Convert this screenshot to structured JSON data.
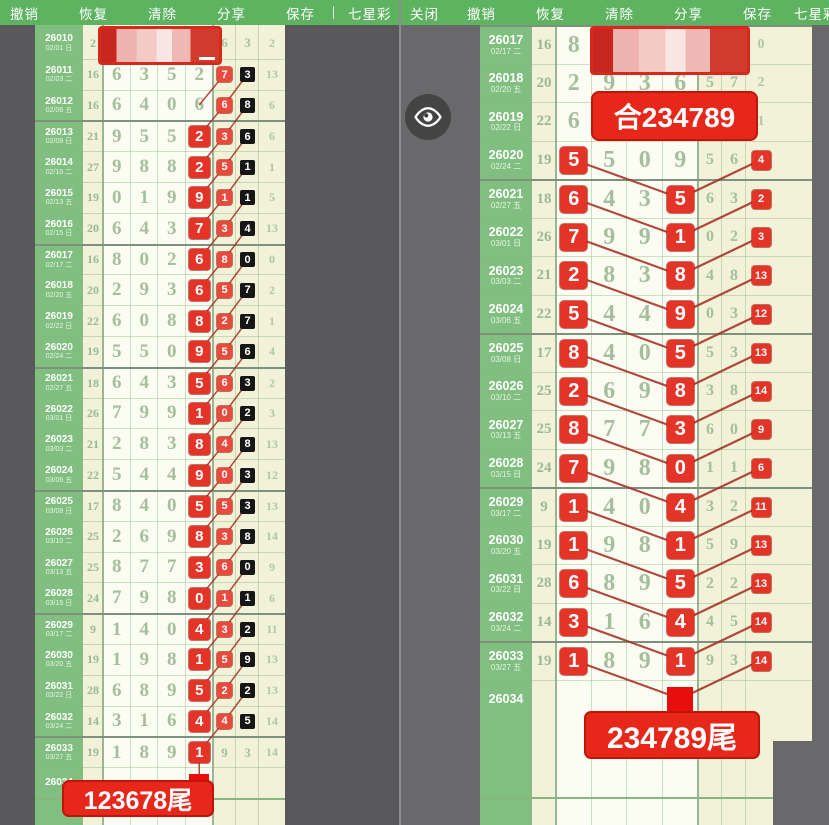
{
  "toolbar_left": {
    "items": [
      "撤销",
      "恢复",
      "清除",
      "分享",
      "保存"
    ],
    "lottery_label": "七星彩"
  },
  "toolbar_right": {
    "close_label": "关闭",
    "items": [
      "撤销",
      "恢复",
      "清除",
      "分享",
      "保存"
    ],
    "lottery_label": "七星彩"
  },
  "colors": {
    "accent_red": "#e43428",
    "toolbar_green": "#5db360",
    "panel_green": "#81bf81",
    "cream": "#f1f2d7",
    "black_mark": "#161616"
  },
  "left_panel": {
    "tail_label": "123678尾",
    "rows": [
      {
        "issue": "26010",
        "date": "02/01 日",
        "sum": "2",
        "d": [
          "",
          "",
          "",
          "",
          "6",
          "3"
        ],
        "m": [
          null,
          null,
          null,
          null,
          null,
          null
        ],
        "last": "2",
        "censored": true
      },
      {
        "issue": "26011",
        "date": "02/03 二",
        "sum": "16",
        "d": [
          "6",
          "3",
          "5",
          "2",
          "7",
          "3"
        ],
        "m": [
          null,
          null,
          null,
          null,
          "r",
          "b"
        ],
        "last": "13"
      },
      {
        "issue": "26012",
        "date": "02/06 五",
        "sum": "16",
        "d": [
          "6",
          "4",
          "0",
          "6",
          "6",
          "8"
        ],
        "m": [
          null,
          null,
          null,
          null,
          "r",
          "b"
        ],
        "last": "6"
      },
      {
        "issue": "26013",
        "date": "02/08 日",
        "sum": "21",
        "d": [
          "9",
          "5",
          "5",
          "2",
          "3",
          "6"
        ],
        "m": [
          null,
          null,
          null,
          "R",
          "r",
          "b"
        ],
        "last": "6"
      },
      {
        "issue": "26014",
        "date": "02/10 二",
        "sum": "27",
        "d": [
          "9",
          "8",
          "8",
          "2",
          "5",
          "1"
        ],
        "m": [
          null,
          null,
          null,
          "R",
          "r",
          "b"
        ],
        "last": "1"
      },
      {
        "issue": "26015",
        "date": "02/13 五",
        "sum": "19",
        "d": [
          "0",
          "1",
          "9",
          "9",
          "1",
          "1"
        ],
        "m": [
          null,
          null,
          null,
          "R",
          "r",
          "b"
        ],
        "last": "5"
      },
      {
        "issue": "26016",
        "date": "02/15 日",
        "sum": "20",
        "d": [
          "6",
          "4",
          "3",
          "7",
          "3",
          "4"
        ],
        "m": [
          null,
          null,
          null,
          "R",
          "r",
          "b"
        ],
        "last": "13"
      },
      {
        "issue": "26017",
        "date": "02/17 二",
        "sum": "16",
        "d": [
          "8",
          "0",
          "2",
          "6",
          "8",
          "0"
        ],
        "m": [
          null,
          null,
          null,
          "R",
          "r",
          "b"
        ],
        "last": "0"
      },
      {
        "issue": "26018",
        "date": "02/20 五",
        "sum": "20",
        "d": [
          "2",
          "9",
          "3",
          "6",
          "5",
          "7"
        ],
        "m": [
          null,
          null,
          null,
          "R",
          "r",
          "b"
        ],
        "last": "2"
      },
      {
        "issue": "26019",
        "date": "02/22 日",
        "sum": "22",
        "d": [
          "6",
          "0",
          "8",
          "8",
          "2",
          "7"
        ],
        "m": [
          null,
          null,
          null,
          "R",
          "r",
          "b"
        ],
        "last": "1"
      },
      {
        "issue": "26020",
        "date": "02/24 二",
        "sum": "19",
        "d": [
          "5",
          "5",
          "0",
          "9",
          "5",
          "6"
        ],
        "m": [
          null,
          null,
          null,
          "R",
          "r",
          "b"
        ],
        "last": "4"
      },
      {
        "issue": "26021",
        "date": "02/27 五",
        "sum": "18",
        "d": [
          "6",
          "4",
          "3",
          "5",
          "6",
          "3"
        ],
        "m": [
          null,
          null,
          null,
          "R",
          "r",
          "b"
        ],
        "last": "2"
      },
      {
        "issue": "26022",
        "date": "03/01 日",
        "sum": "26",
        "d": [
          "7",
          "9",
          "9",
          "1",
          "0",
          "2"
        ],
        "m": [
          null,
          null,
          null,
          "R",
          "r",
          "b"
        ],
        "last": "3"
      },
      {
        "issue": "26023",
        "date": "03/03 二",
        "sum": "21",
        "d": [
          "2",
          "8",
          "3",
          "8",
          "4",
          "8"
        ],
        "m": [
          null,
          null,
          null,
          "R",
          "r",
          "b"
        ],
        "last": "13"
      },
      {
        "issue": "26024",
        "date": "03/06 五",
        "sum": "22",
        "d": [
          "5",
          "4",
          "4",
          "9",
          "0",
          "3"
        ],
        "m": [
          null,
          null,
          null,
          "R",
          "r",
          "b"
        ],
        "last": "12"
      },
      {
        "issue": "26025",
        "date": "03/08 日",
        "sum": "17",
        "d": [
          "8",
          "4",
          "0",
          "5",
          "5",
          "3"
        ],
        "m": [
          null,
          null,
          null,
          "R",
          "r",
          "b"
        ],
        "last": "13"
      },
      {
        "issue": "26026",
        "date": "03/10 二",
        "sum": "25",
        "d": [
          "2",
          "6",
          "9",
          "8",
          "3",
          "8"
        ],
        "m": [
          null,
          null,
          null,
          "R",
          "r",
          "b"
        ],
        "last": "14"
      },
      {
        "issue": "26027",
        "date": "03/13 五",
        "sum": "25",
        "d": [
          "8",
          "7",
          "7",
          "3",
          "6",
          "0"
        ],
        "m": [
          null,
          null,
          null,
          "R",
          "r",
          "b"
        ],
        "last": "9"
      },
      {
        "issue": "26028",
        "date": "03/15 日",
        "sum": "24",
        "d": [
          "7",
          "9",
          "8",
          "0",
          "1",
          "1"
        ],
        "m": [
          null,
          null,
          null,
          "R",
          "r",
          "b"
        ],
        "last": "6"
      },
      {
        "issue": "26029",
        "date": "03/17 二",
        "sum": "9",
        "d": [
          "1",
          "4",
          "0",
          "4",
          "3",
          "2"
        ],
        "m": [
          null,
          null,
          null,
          "R",
          "r",
          "b"
        ],
        "last": "11"
      },
      {
        "issue": "26030",
        "date": "03/20 五",
        "sum": "19",
        "d": [
          "1",
          "9",
          "8",
          "1",
          "5",
          "9"
        ],
        "m": [
          null,
          null,
          null,
          "R",
          "r",
          "b"
        ],
        "last": "13"
      },
      {
        "issue": "26031",
        "date": "03/22 日",
        "sum": "28",
        "d": [
          "6",
          "8",
          "9",
          "5",
          "2",
          "2"
        ],
        "m": [
          null,
          null,
          null,
          "R",
          "r",
          "b"
        ],
        "last": "13"
      },
      {
        "issue": "26032",
        "date": "03/24 二",
        "sum": "14",
        "d": [
          "3",
          "1",
          "6",
          "4",
          "4",
          "5"
        ],
        "m": [
          null,
          null,
          null,
          "R",
          "r",
          "b"
        ],
        "last": "14"
      },
      {
        "issue": "26033",
        "date": "03/27 五",
        "sum": "19",
        "d": [
          "1",
          "8",
          "9",
          "1",
          "9",
          "3"
        ],
        "m": [
          null,
          null,
          null,
          "R",
          null,
          null
        ],
        "last": "14"
      },
      {
        "issue": "26034",
        "date": "",
        "sum": "",
        "d": [
          "",
          "",
          "",
          "",
          "",
          ""
        ],
        "m": [
          null,
          null,
          null,
          "SQ",
          null,
          null
        ],
        "last": ""
      }
    ]
  },
  "right_panel": {
    "tail_label": "234789尾",
    "sum_annotation": "合234789",
    "rows": [
      {
        "issue": "26017",
        "date": "02/17 二",
        "sum": "16",
        "d": [
          "8",
          "",
          "",
          "",
          "",
          ""
        ],
        "m": [
          null,
          null,
          null,
          null,
          null,
          null
        ],
        "last": "0",
        "censored": true
      },
      {
        "issue": "26018",
        "date": "02/20 五",
        "sum": "20",
        "d": [
          "2",
          "9",
          "3",
          "6",
          "5",
          "7"
        ],
        "m": [
          null,
          null,
          null,
          null,
          null,
          null
        ],
        "last": "2"
      },
      {
        "issue": "26019",
        "date": "02/22 日",
        "sum": "22",
        "d": [
          "6",
          "",
          "",
          "",
          "",
          ""
        ],
        "m": [
          null,
          null,
          null,
          null,
          null,
          null
        ],
        "last": "1"
      },
      {
        "issue": "26020",
        "date": "02/24 二",
        "sum": "19",
        "d": [
          "5",
          "5",
          "0",
          "9",
          "5",
          "6"
        ],
        "m": [
          "R",
          null,
          null,
          null,
          null,
          null
        ],
        "last": "4",
        "lastM": "R"
      },
      {
        "issue": "26021",
        "date": "02/27 五",
        "sum": "18",
        "d": [
          "6",
          "4",
          "3",
          "5",
          "6",
          "3"
        ],
        "m": [
          "R",
          null,
          null,
          "R",
          null,
          null
        ],
        "last": "2",
        "lastM": "R"
      },
      {
        "issue": "26022",
        "date": "03/01 日",
        "sum": "26",
        "d": [
          "7",
          "9",
          "9",
          "1",
          "0",
          "2"
        ],
        "m": [
          "R",
          null,
          null,
          "R",
          null,
          null
        ],
        "last": "3",
        "lastM": "R"
      },
      {
        "issue": "26023",
        "date": "03/03 二",
        "sum": "21",
        "d": [
          "2",
          "8",
          "3",
          "8",
          "4",
          "8"
        ],
        "m": [
          "R",
          null,
          null,
          "R",
          null,
          null
        ],
        "last": "13",
        "lastM": "R"
      },
      {
        "issue": "26024",
        "date": "03/06 五",
        "sum": "22",
        "d": [
          "5",
          "4",
          "4",
          "9",
          "0",
          "3"
        ],
        "m": [
          "R",
          null,
          null,
          "R",
          null,
          null
        ],
        "last": "12",
        "lastM": "R"
      },
      {
        "issue": "26025",
        "date": "03/08 日",
        "sum": "17",
        "d": [
          "8",
          "4",
          "0",
          "5",
          "5",
          "3"
        ],
        "m": [
          "R",
          null,
          null,
          "R",
          null,
          null
        ],
        "last": "13",
        "lastM": "R"
      },
      {
        "issue": "26026",
        "date": "03/10 二",
        "sum": "25",
        "d": [
          "2",
          "6",
          "9",
          "8",
          "3",
          "8"
        ],
        "m": [
          "R",
          null,
          null,
          "R",
          null,
          null
        ],
        "last": "14",
        "lastM": "R"
      },
      {
        "issue": "26027",
        "date": "03/13 五",
        "sum": "25",
        "d": [
          "8",
          "7",
          "7",
          "3",
          "6",
          "0"
        ],
        "m": [
          "R",
          null,
          null,
          "R",
          null,
          null
        ],
        "last": "9",
        "lastM": "R"
      },
      {
        "issue": "26028",
        "date": "03/15 日",
        "sum": "24",
        "d": [
          "7",
          "9",
          "8",
          "0",
          "1",
          "1"
        ],
        "m": [
          "R",
          null,
          null,
          "R",
          null,
          null
        ],
        "last": "6",
        "lastM": "R"
      },
      {
        "issue": "26029",
        "date": "03/17 二",
        "sum": "9",
        "d": [
          "1",
          "4",
          "0",
          "4",
          "3",
          "2"
        ],
        "m": [
          "R",
          null,
          null,
          "R",
          null,
          null
        ],
        "last": "11",
        "lastM": "R"
      },
      {
        "issue": "26030",
        "date": "03/20 五",
        "sum": "19",
        "d": [
          "1",
          "9",
          "8",
          "1",
          "5",
          "9"
        ],
        "m": [
          "R",
          null,
          null,
          "R",
          null,
          null
        ],
        "last": "13",
        "lastM": "R"
      },
      {
        "issue": "26031",
        "date": "03/22 日",
        "sum": "28",
        "d": [
          "6",
          "8",
          "9",
          "5",
          "2",
          "2"
        ],
        "m": [
          "R",
          null,
          null,
          "R",
          null,
          null
        ],
        "last": "13",
        "lastM": "R"
      },
      {
        "issue": "26032",
        "date": "03/24 二",
        "sum": "14",
        "d": [
          "3",
          "1",
          "6",
          "4",
          "4",
          "5"
        ],
        "m": [
          "R",
          null,
          null,
          "R",
          null,
          null
        ],
        "last": "14",
        "lastM": "R"
      },
      {
        "issue": "26033",
        "date": "03/27 五",
        "sum": "19",
        "d": [
          "1",
          "8",
          "9",
          "1",
          "9",
          "3"
        ],
        "m": [
          "R",
          null,
          null,
          "R",
          null,
          null
        ],
        "last": "14",
        "lastM": "R"
      },
      {
        "issue": "26034",
        "date": "",
        "sum": "",
        "d": [
          "",
          "",
          "",
          "",
          "",
          ""
        ],
        "m": [
          null,
          null,
          null,
          "SQ",
          null,
          null
        ],
        "last": ""
      }
    ]
  }
}
